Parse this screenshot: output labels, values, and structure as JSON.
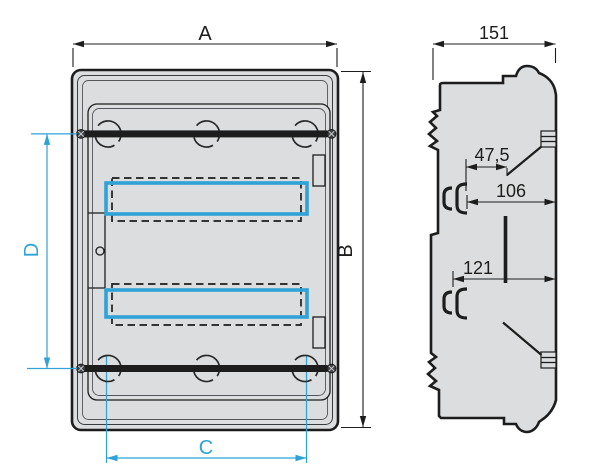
{
  "colors": {
    "accent_cyan": "#2fa2d8",
    "line_black": "#1d1d1d",
    "enclosure_fill": "#dcddde",
    "background": "#ffffff"
  },
  "front_view": {
    "dim_width": "A",
    "dim_height": "B",
    "dim_bottom_width": "C",
    "dim_rail_spacing": "D"
  },
  "side_view": {
    "dim_depth": "151",
    "dim_rail_offset": "47,5",
    "dim_depth_upper": "106",
    "dim_depth_lower": "121"
  }
}
